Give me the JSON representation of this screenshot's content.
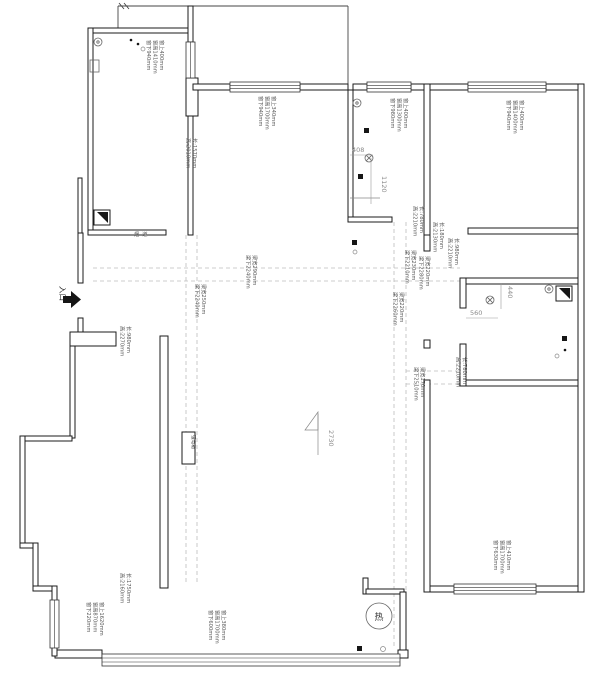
{
  "drawing": {
    "labels": {
      "entrance": "入口",
      "flue": "烟道",
      "electrical_box": "强电箱",
      "water_heater": "热",
      "floor_height": "2730"
    },
    "dims": {
      "d408": "408",
      "d1120": "1120",
      "d440": "440",
      "d560": "560"
    },
    "windows": [
      {
        "lines": [
          "窗上400mm",
          "窗高1410mm",
          "窗下940mm"
        ]
      },
      {
        "lines": [
          "窗上340mm",
          "窗高1700mm",
          "窗下940mm"
        ]
      },
      {
        "lines": [
          "窗上400mm",
          "窗高1300mm",
          "窗下980mm"
        ]
      },
      {
        "lines": [
          "窗上400mm",
          "窗高1400mm",
          "窗下940mm"
        ]
      },
      {
        "lines": [
          "窗上1620mm",
          "窗高870mm",
          "窗下220mm"
        ]
      },
      {
        "lines": [
          "窗上380mm",
          "窗高1700mm",
          "窗下600mm"
        ]
      },
      {
        "lines": [
          "窗上410mm",
          "窗高1700mm",
          "窗下630mm"
        ]
      }
    ],
    "openings": [
      {
        "lines": [
          "长:1570mm",
          "高:2010mm"
        ]
      },
      {
        "lines": [
          "长:980mm",
          "高:2270mm"
        ]
      },
      {
        "lines": [
          "长:780mm",
          "高:2210mm"
        ]
      },
      {
        "lines": [
          "长:180mm",
          "高:2130mm"
        ]
      },
      {
        "lines": [
          "长:980mm",
          "高:2210mm"
        ]
      },
      {
        "lines": [
          "长:780mm",
          "高:2210mm"
        ]
      },
      {
        "lines": [
          "长:1750mm",
          "高:2160mm"
        ]
      }
    ],
    "beams": [
      {
        "lines": [
          "梁宽290mm",
          "梁下2240mm"
        ]
      },
      {
        "lines": [
          "梁宽250mm",
          "梁下2240mm"
        ]
      },
      {
        "lines": [
          "梁宽230mm",
          "梁下2210mm"
        ]
      },
      {
        "lines": [
          "梁宽220mm",
          "梁下2280mm"
        ]
      },
      {
        "lines": [
          "梁宽220mm",
          "梁下2260mm"
        ]
      },
      {
        "lines": [
          "梁宽170mm",
          "梁下2510mm"
        ]
      }
    ]
  }
}
